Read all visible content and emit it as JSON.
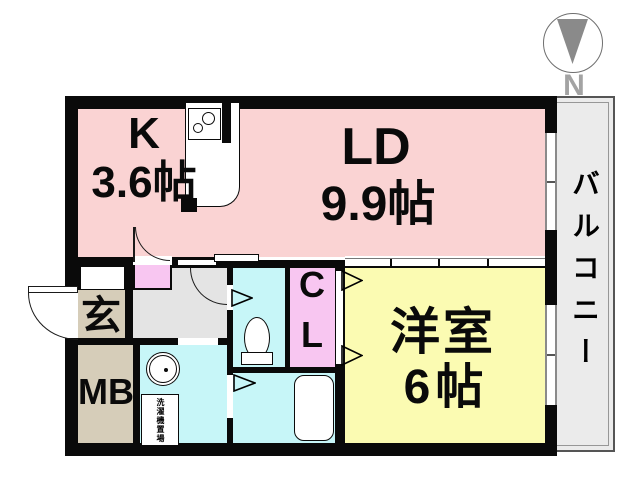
{
  "floorplan": {
    "rooms": {
      "kitchen": {
        "code": "K",
        "area": "3.6帖"
      },
      "living_dining": {
        "code": "LD",
        "area": "9.9帖"
      },
      "western_room": {
        "name": "洋室",
        "area": "6帖"
      },
      "closet": {
        "label_top": "C",
        "label_bottom": "L"
      },
      "entrance": {
        "label": "玄"
      },
      "meter_box": {
        "label": "MB"
      },
      "balcony": {
        "label": "バルコニー"
      },
      "laundry_space": {
        "label": "洗濯機置場"
      }
    },
    "compass": {
      "north_label": "N"
    },
    "colors": {
      "ldk_pink": "#fad3d3",
      "closet_magenta": "#f8c6f1",
      "western_yellow": "#fbfbb2",
      "wet_area_cyan": "#c7f6f8",
      "entrance_tan": "#d6cdb9",
      "hall_gray": "#e4e4e4",
      "balcony_gray": "#ebebeb",
      "wall_black": "#000000",
      "compass_gray": "#8a8a8a"
    }
  }
}
